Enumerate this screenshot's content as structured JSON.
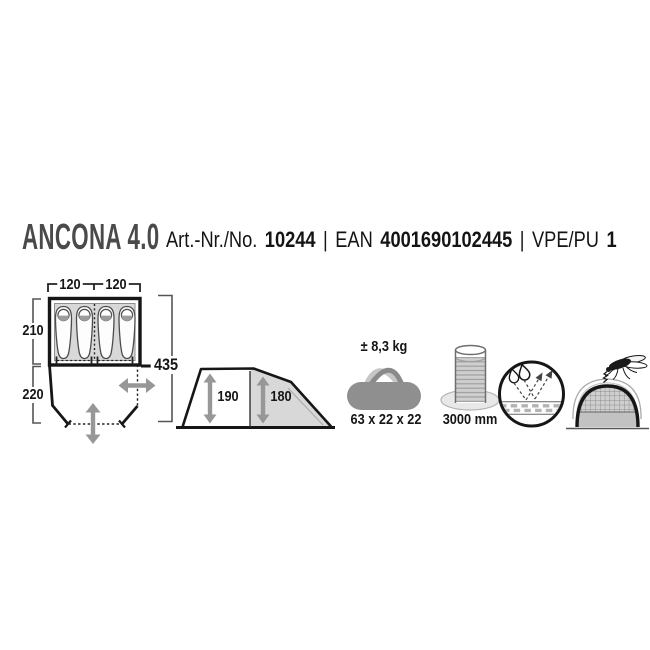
{
  "header": {
    "product_name": "ANCONA 4.0",
    "art_label": "Art.-Nr./No.",
    "art_value": "10244",
    "separator": "|",
    "ean_label": "EAN",
    "ean_value": "4001690102445",
    "separator2": "|",
    "vpe_label": "VPE/PU",
    "vpe_value": "1"
  },
  "floorplan": {
    "cabin_width_left": "120",
    "cabin_width_right": "120",
    "cabin_depth": "210",
    "porch_depth": "220",
    "total_length": "435",
    "sleeping_pads_visible": 4
  },
  "side_view": {
    "front_height": "190",
    "rear_height": "180"
  },
  "pack_bag": {
    "weight": "± 8,3 kg",
    "pack_size": "63 x 22 x 22"
  },
  "water_column": {
    "value": "3000 mm"
  },
  "icons": {
    "pack_bag": "duffel-bag-icon",
    "water_column": "water-column-icon",
    "breathability": "breathable-fabric-icon",
    "mosquito_protection": "mosquito-mesh-icon"
  },
  "colors": {
    "title_gray": "#4a4a4a",
    "text_black": "#141414",
    "diagram_fill_gray": "#d8d8d8",
    "arrow_gray": "#979797",
    "bag_gray": "#8f8f8f"
  }
}
